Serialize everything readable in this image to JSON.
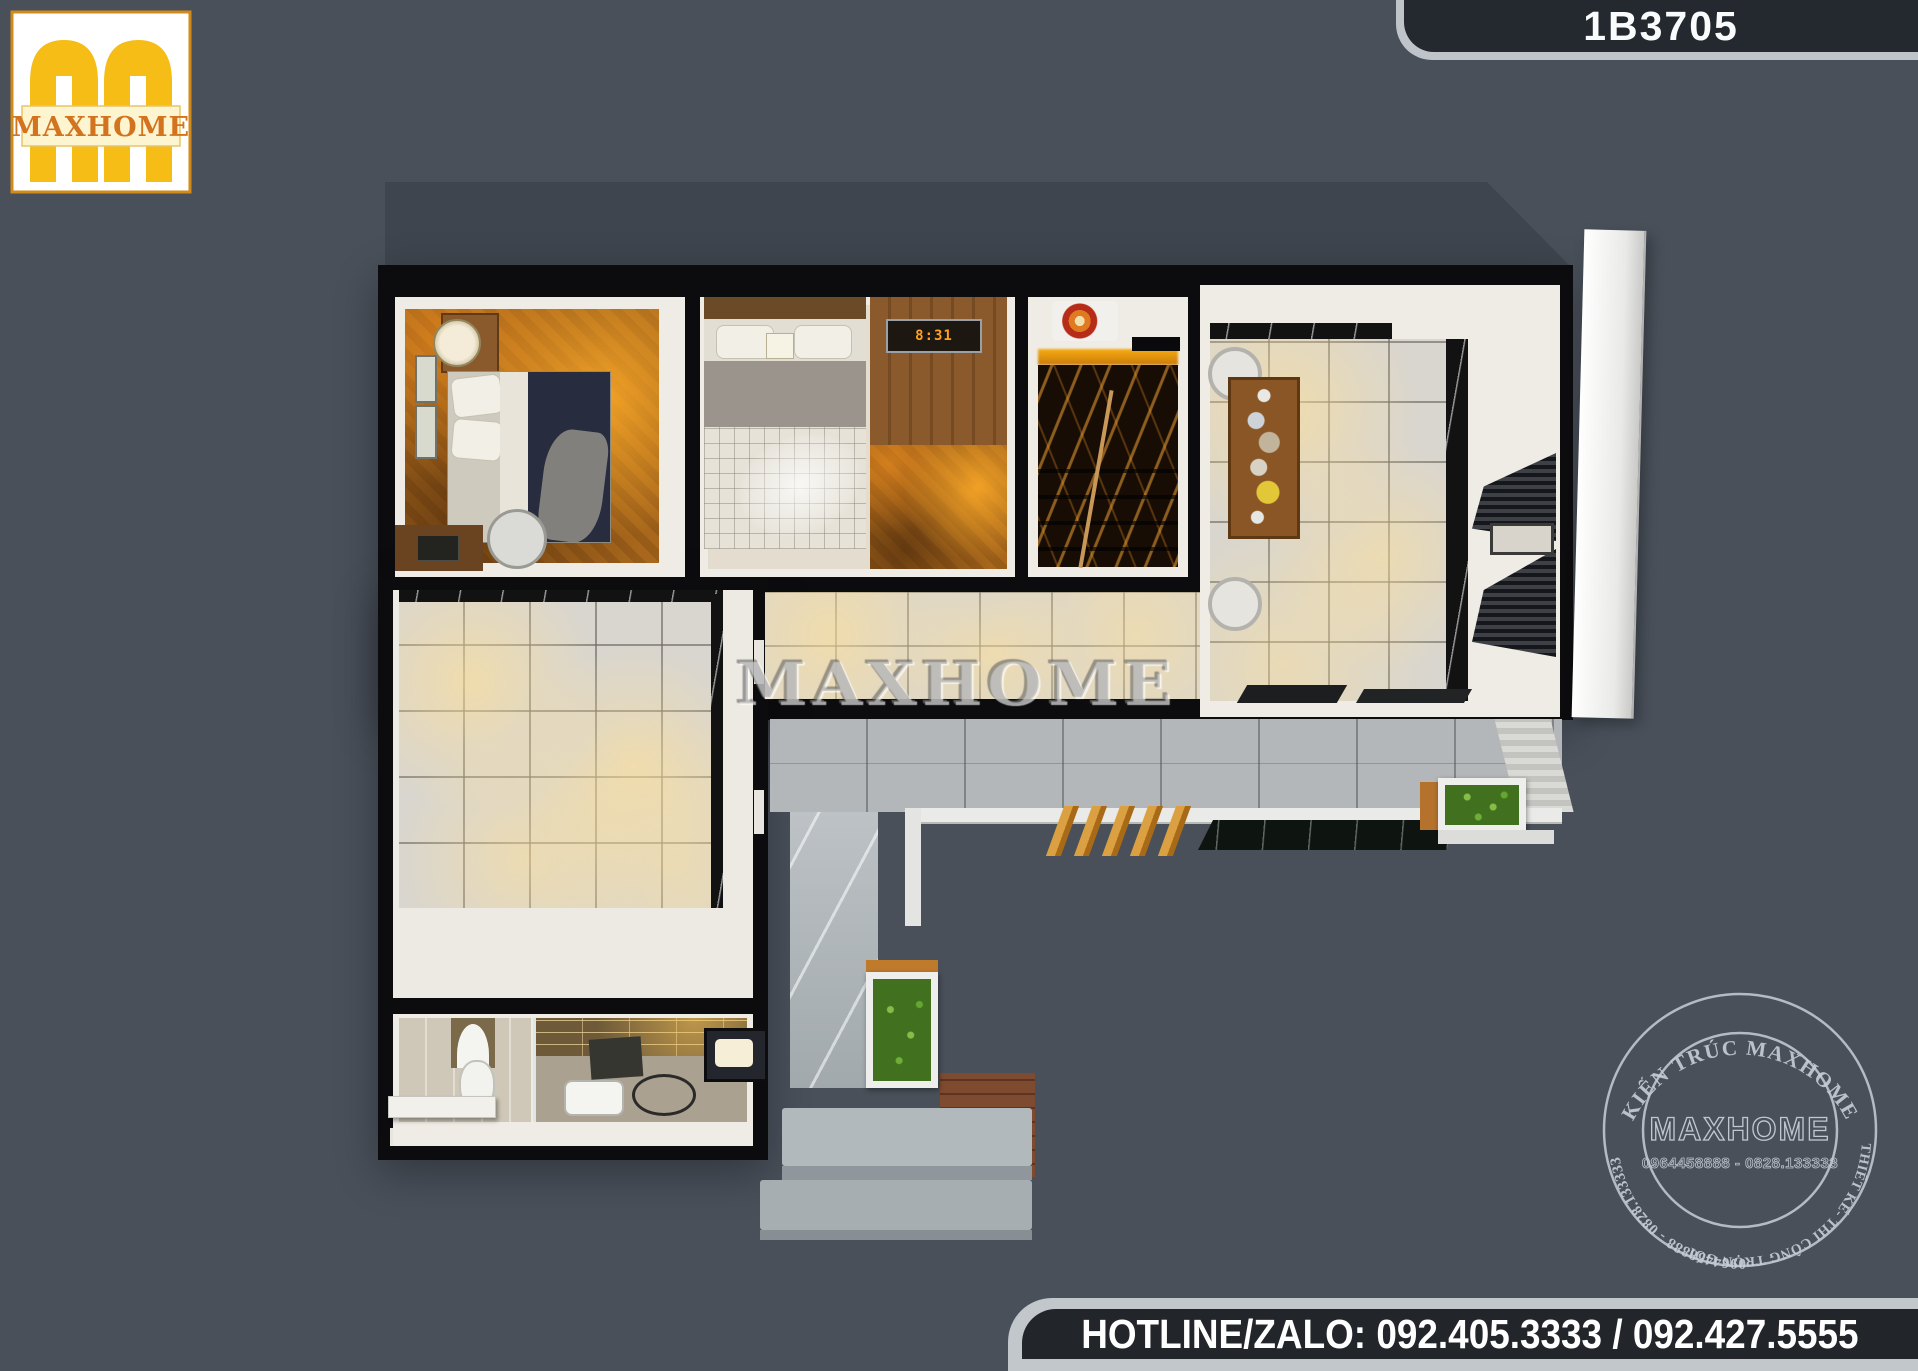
{
  "logo": {
    "brand": "MAXHOME",
    "color_yellow": "#f6bd16",
    "color_text": "#d4731e"
  },
  "badge": {
    "code": "1B3705"
  },
  "watermark": {
    "text": "MAXHOME"
  },
  "floor_plan": {
    "bedroom2_clock": "8:31"
  },
  "stamp": {
    "arc_top": "KIẾN TRÚC MAXHOME",
    "arc_right": "THIẾT KẾ- THI CÔNG TRỌN GÓI",
    "arc_left": "0964458888 - 0828.133333",
    "center_brand": "MAXHOME",
    "center_phones": "0964458888 - 0828.133333"
  },
  "footer": {
    "hotline": "HOTLINE/ZALO: 092.405.3333 / 092.427.5555"
  },
  "colors": {
    "background": "#49505a",
    "wall": "#0c0c0f",
    "stamp_ink": "#dde3ea"
  }
}
